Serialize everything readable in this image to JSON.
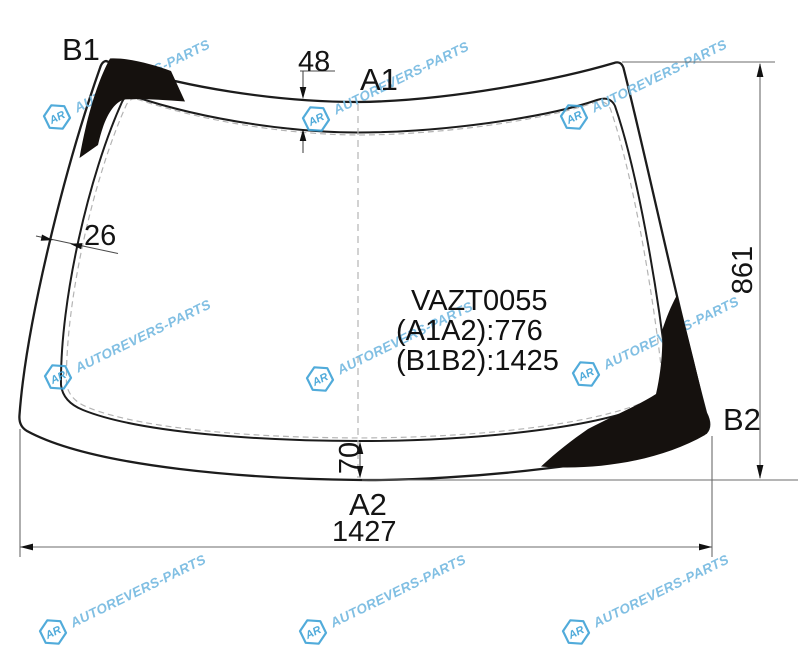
{
  "part": {
    "code": "VAZT0055",
    "dim_a1a2": "(A1A2):776",
    "dim_b1b2": "(B1B2):1425"
  },
  "corner_labels": {
    "b1": "B1",
    "a1": "A1",
    "a2": "A2",
    "b2": "B2"
  },
  "dimensions": {
    "top_strip": "48",
    "left_strip": "26",
    "bottom_strip": "70",
    "height": "861",
    "width": "1427"
  },
  "watermark": {
    "logo": "AR",
    "text": "AUTOREVERS-PARTS",
    "color": "#74b9e0",
    "logo_color": "#3fa3d7"
  },
  "colors": {
    "outline": "#1c1c1c",
    "tint_mark": "#15110e",
    "dim_line": "#6b6b6b",
    "dashed": "#b3b3b3"
  }
}
